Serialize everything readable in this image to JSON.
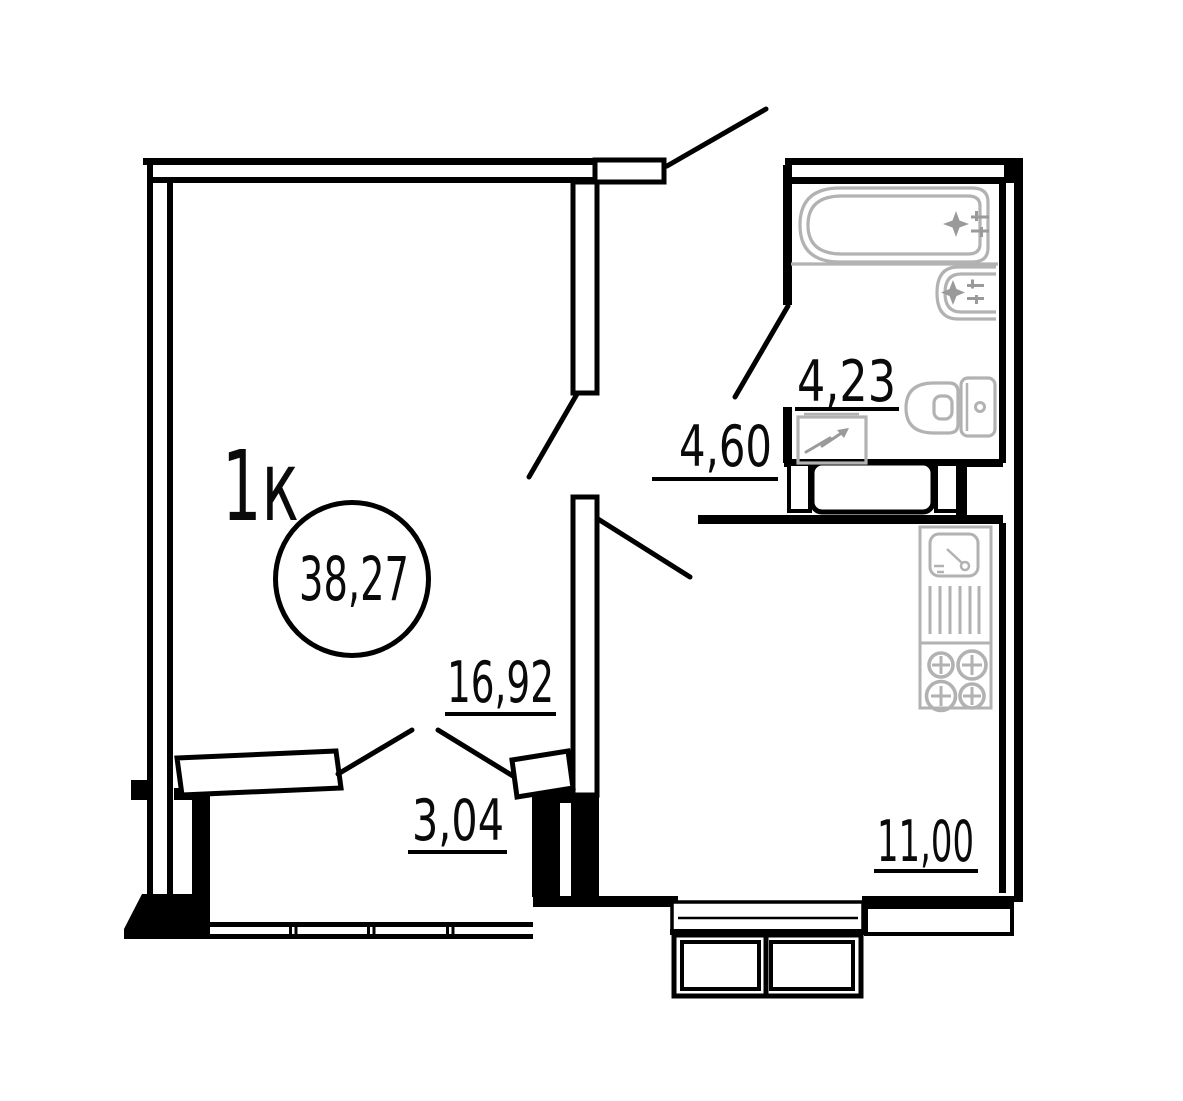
{
  "plan": {
    "apartment_type": "1к",
    "total_area": "38,27",
    "rooms": {
      "living_room": "16,92",
      "hallway": "3,04",
      "corridor": "4,60",
      "bathroom": "4,23",
      "kitchen": "11,00"
    },
    "colors": {
      "wall": "#000000",
      "fixture": "#b2b2b2",
      "background": "#ffffff"
    }
  }
}
